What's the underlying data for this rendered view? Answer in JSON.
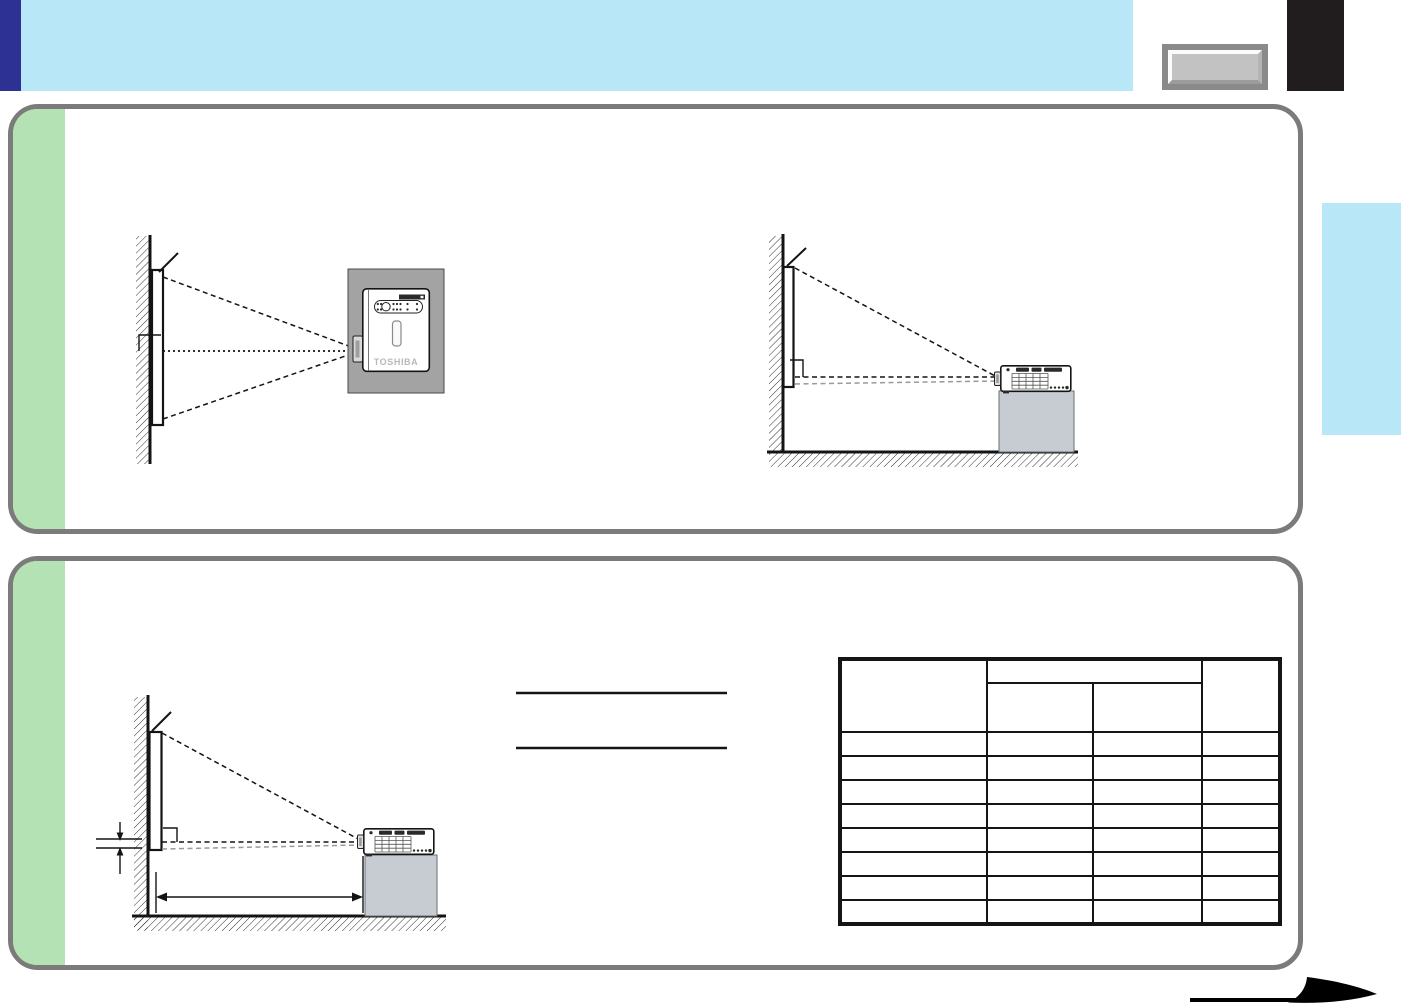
{
  "branding": {
    "projector_logo": "TOSHIBA"
  },
  "colors": {
    "header_blue": "#b8e7f7",
    "accent_dark_blue": "#2d3193",
    "panel_green": "#b5e2b5",
    "panel_border": "#7b7b7b",
    "ceiling_gray": "#a3a3a3",
    "pedestal_gray": "#c7ccd2",
    "corner_black": "#211d1e",
    "button_frame": "#8a8a8a",
    "button_face": "#c2c2c2",
    "side_tab_blue": "#b8e7f7"
  },
  "table": {
    "column_count": 4,
    "data_row_count": 8
  }
}
